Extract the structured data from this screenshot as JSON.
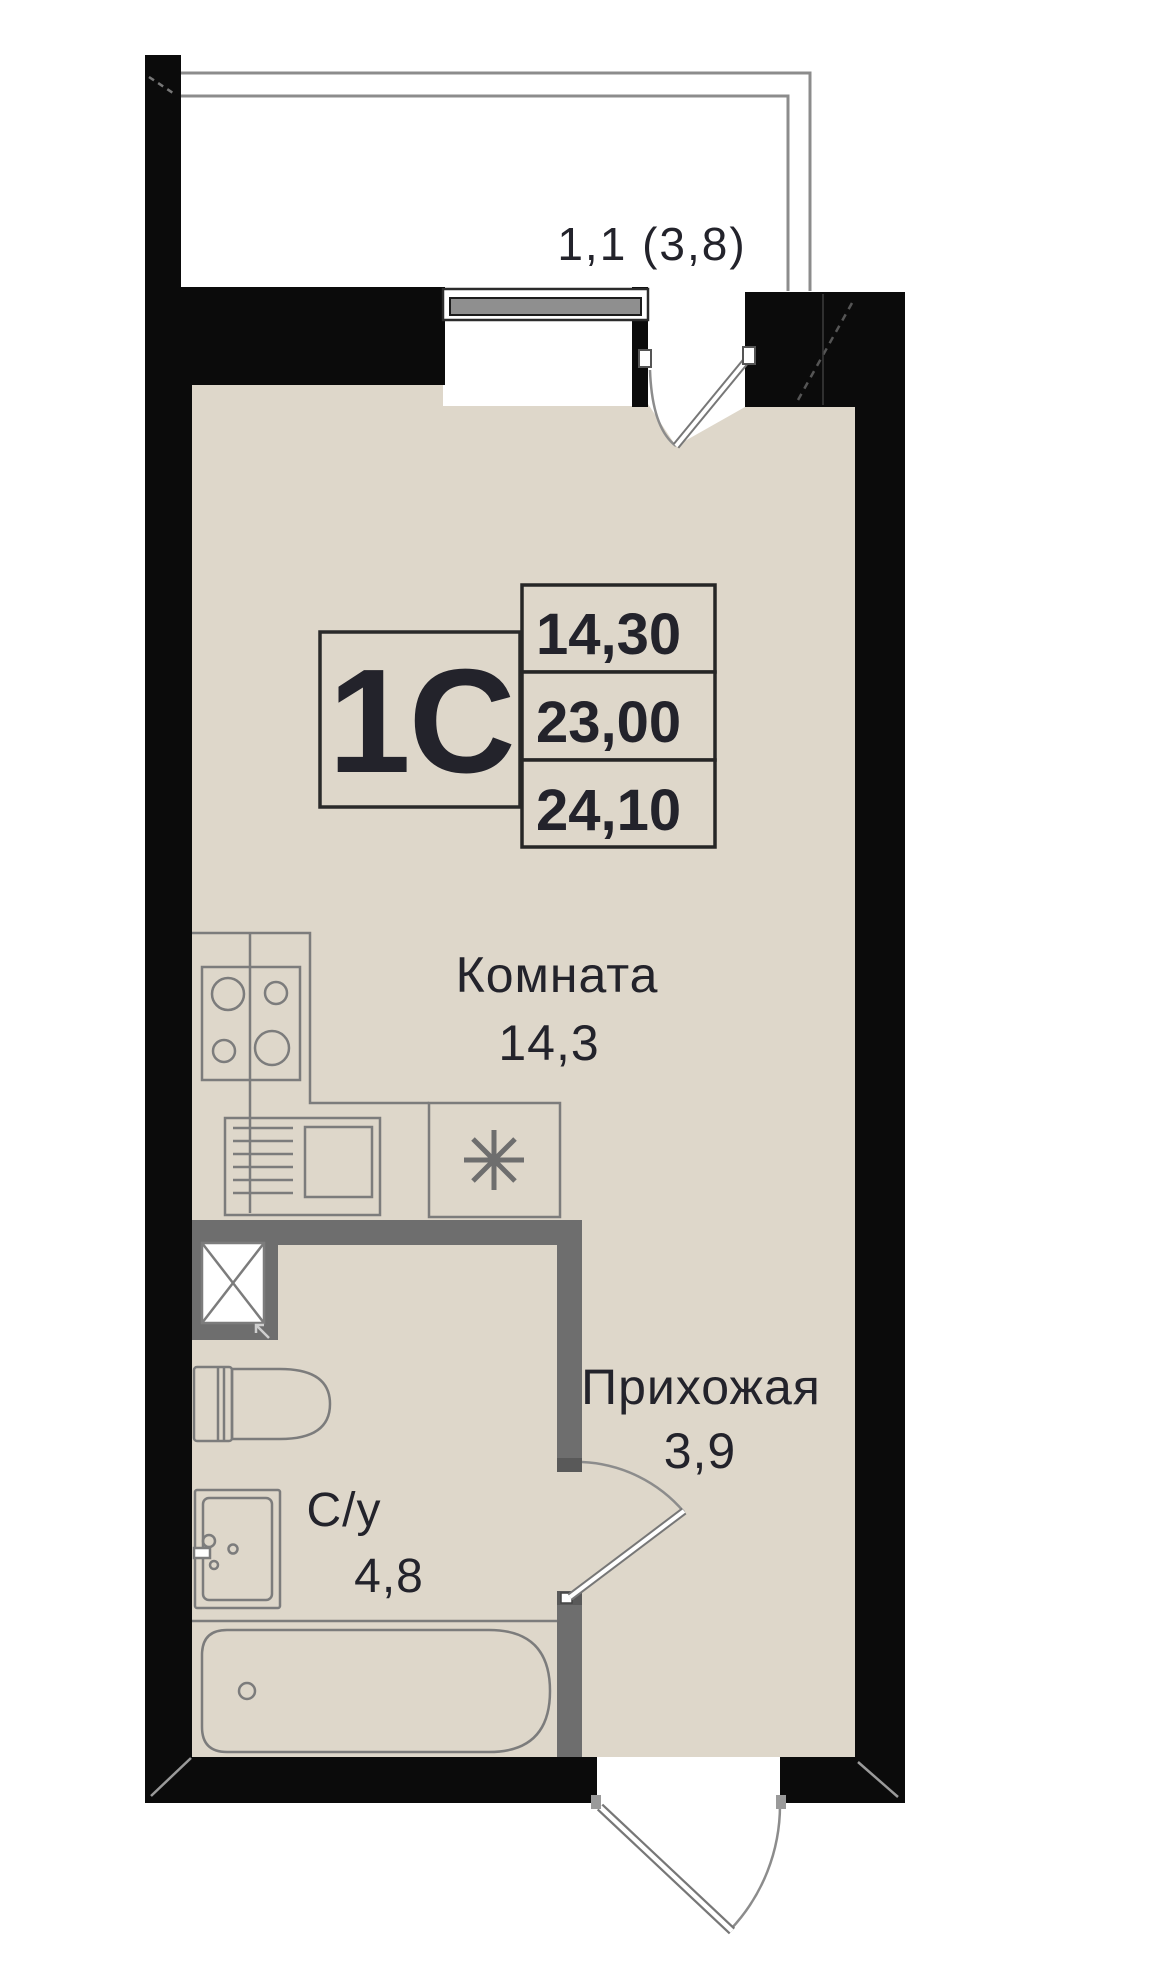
{
  "plan": {
    "unit_label": "1С",
    "balcony_label": "1,1 (3,8)",
    "area_table": {
      "rows": [
        "14,30",
        "23,00",
        "24,10"
      ]
    },
    "rooms": [
      {
        "name": "Комната",
        "area": "14,3"
      },
      {
        "name": "Прихожая",
        "area": "3,9"
      },
      {
        "name": "С/у",
        "area": "4,8"
      }
    ],
    "colors": {
      "floor": "#DED7CA",
      "wall": "#0B0B0B",
      "partition": "#6E6E6E",
      "fixture": "#7C7C7C",
      "glazing": "#8C8C8C",
      "window_bar": "#8F8F8F",
      "label": "#23232B",
      "border": "#262626",
      "hinge": "#595959"
    }
  }
}
